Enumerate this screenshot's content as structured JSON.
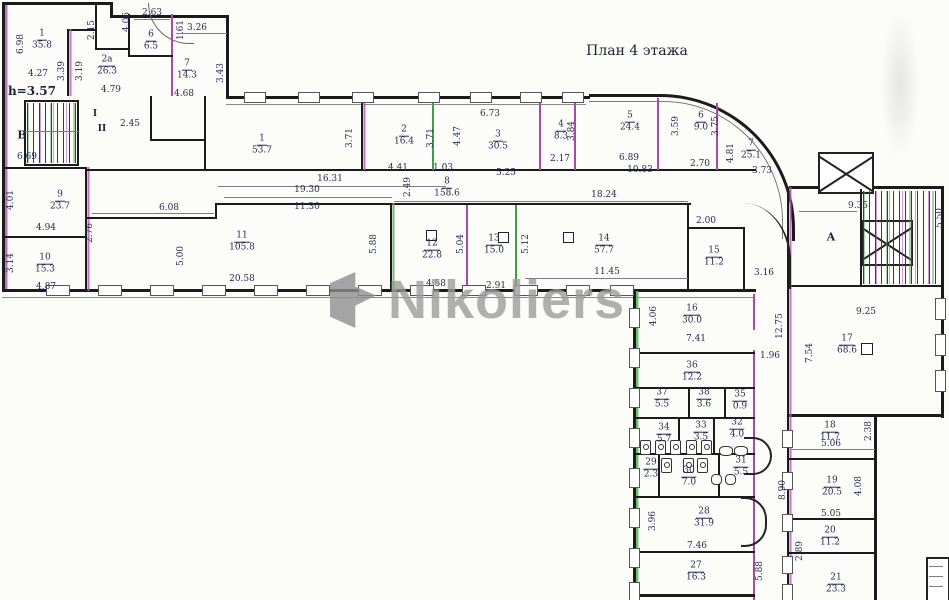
{
  "plan": {
    "title": "План 4 этажа",
    "height_note": "h=3.57",
    "section_markers": [
      "I",
      "II"
    ],
    "stairwell_letters": [
      "В",
      "А"
    ],
    "colors": {
      "wall": "#1b1b1b",
      "accent_magenta": "#a94aa9",
      "accent_green": "#3f9e49",
      "dim_text": "#232c55",
      "watermark_gray": "#9c9c9c",
      "background": "#fcfcf9"
    },
    "rooms": [
      {
        "n": "1",
        "a": "35.8",
        "x": 42,
        "y": 40
      },
      {
        "n": "2а",
        "a": "26.3",
        "x": 107,
        "y": 66
      },
      {
        "n": "6",
        "a": "6.5",
        "x": 151,
        "y": 41
      },
      {
        "n": "7",
        "a": "14.3",
        "x": 187,
        "y": 70
      },
      {
        "n": "1",
        "a": "53.7",
        "x": 262,
        "y": 145
      },
      {
        "n": "2",
        "a": "16.4",
        "x": 404,
        "y": 136
      },
      {
        "n": "3",
        "a": "30.5",
        "x": 498,
        "y": 141
      },
      {
        "n": "4",
        "a": "8.3",
        "x": 561,
        "y": 131
      },
      {
        "n": "5",
        "a": "24.4",
        "x": 630,
        "y": 122
      },
      {
        "n": "6",
        "a": "9.0",
        "x": 701,
        "y": 122
      },
      {
        "n": "7",
        "a": "25.1",
        "x": 751,
        "y": 150
      },
      {
        "n": "8",
        "a": "158.6",
        "x": 447,
        "y": 188
      },
      {
        "n": "9",
        "a": "23.7",
        "x": 60,
        "y": 201
      },
      {
        "n": "10",
        "a": "15.3",
        "x": 45,
        "y": 264
      },
      {
        "n": "11",
        "a": "105.8",
        "x": 242,
        "y": 242
      },
      {
        "n": "12",
        "a": "22.8",
        "x": 432,
        "y": 250
      },
      {
        "n": "13",
        "a": "15.0",
        "x": 494,
        "y": 245
      },
      {
        "n": "14",
        "a": "57.7",
        "x": 604,
        "y": 245
      },
      {
        "n": "15",
        "a": "11.2",
        "x": 714,
        "y": 257
      },
      {
        "n": "16",
        "a": "30.0",
        "x": 692,
        "y": 315
      },
      {
        "n": "17",
        "a": "68.6",
        "x": 847,
        "y": 345
      },
      {
        "n": "18",
        "a": "11.7",
        "x": 830,
        "y": 432
      },
      {
        "n": "19",
        "a": "20.5",
        "x": 832,
        "y": 487
      },
      {
        "n": "20",
        "a": "11.2",
        "x": 830,
        "y": 537
      },
      {
        "n": "21",
        "a": "23.3",
        "x": 836,
        "y": 584
      },
      {
        "n": "27",
        "a": "16.3",
        "x": 696,
        "y": 572
      },
      {
        "n": "28",
        "a": "31.9",
        "x": 704,
        "y": 518
      },
      {
        "n": "29",
        "a": "2.3",
        "x": 651,
        "y": 469
      },
      {
        "n": "30",
        "a": "7.0",
        "x": 689,
        "y": 477
      },
      {
        "n": "31",
        "a": "5.5",
        "x": 741,
        "y": 467
      },
      {
        "n": "32",
        "a": "4.0",
        "x": 737,
        "y": 429
      },
      {
        "n": "33",
        "a": "3.5",
        "x": 701,
        "y": 432
      },
      {
        "n": "34",
        "a": "5.7",
        "x": 664,
        "y": 434
      },
      {
        "n": "35",
        "a": "0.9",
        "x": 740,
        "y": 401
      },
      {
        "n": "36",
        "a": "12.2",
        "x": 692,
        "y": 372
      },
      {
        "n": "37",
        "a": "5.5",
        "x": 662,
        "y": 399
      },
      {
        "n": "38",
        "a": "3.6",
        "x": 704,
        "y": 399
      }
    ],
    "dimensions": [
      {
        "t": "6.98",
        "x": 21,
        "y": 44,
        "v": true
      },
      {
        "t": "4.27",
        "x": 38,
        "y": 74
      },
      {
        "t": "2.15",
        "x": 92,
        "y": 30,
        "v": true
      },
      {
        "t": "3.39",
        "x": 62,
        "y": 71,
        "v": true
      },
      {
        "t": "3.19",
        "x": 80,
        "y": 71,
        "v": true
      },
      {
        "t": "4.79",
        "x": 111,
        "y": 90
      },
      {
        "t": "2.63",
        "x": 152,
        "y": 13
      },
      {
        "t": "4.06",
        "x": 127,
        "y": 22,
        "v": true
      },
      {
        "t": "1.61",
        "x": 181,
        "y": 30,
        "v": true
      },
      {
        "t": "3.26",
        "x": 197,
        "y": 28
      },
      {
        "t": "3.43",
        "x": 221,
        "y": 73,
        "v": true
      },
      {
        "t": "4.68",
        "x": 184,
        "y": 94
      },
      {
        "t": "2.45",
        "x": 130,
        "y": 124
      },
      {
        "t": "6.69",
        "x": 27,
        "y": 157
      },
      {
        "t": "4.01",
        "x": 11,
        "y": 200,
        "v": true
      },
      {
        "t": "4.94",
        "x": 46,
        "y": 228
      },
      {
        "t": "2.76",
        "x": 90,
        "y": 233,
        "v": true
      },
      {
        "t": "3.14",
        "x": 11,
        "y": 263,
        "v": true
      },
      {
        "t": "4.87",
        "x": 46,
        "y": 287
      },
      {
        "t": "6.08",
        "x": 169,
        "y": 208
      },
      {
        "t": "5.00",
        "x": 181,
        "y": 256,
        "v": true
      },
      {
        "t": "20.58",
        "x": 242,
        "y": 279
      },
      {
        "t": "5.88",
        "x": 374,
        "y": 244,
        "v": true
      },
      {
        "t": "16.31",
        "x": 330,
        "y": 179
      },
      {
        "t": "19.30",
        "x": 307,
        "y": 190
      },
      {
        "t": "11.30",
        "x": 307,
        "y": 207
      },
      {
        "t": "3.71",
        "x": 350,
        "y": 138,
        "v": true
      },
      {
        "t": "2.49",
        "x": 408,
        "y": 187,
        "v": true
      },
      {
        "t": "4.41",
        "x": 398,
        "y": 168
      },
      {
        "t": "3.71",
        "x": 431,
        "y": 138,
        "v": true
      },
      {
        "t": "4.47",
        "x": 458,
        "y": 136,
        "v": true
      },
      {
        "t": "6.73",
        "x": 490,
        "y": 114
      },
      {
        "t": "1.03",
        "x": 443,
        "y": 168
      },
      {
        "t": "5.25",
        "x": 506,
        "y": 173
      },
      {
        "t": "3.84",
        "x": 572,
        "y": 131,
        "v": true
      },
      {
        "t": "2.17",
        "x": 560,
        "y": 159
      },
      {
        "t": "18.24",
        "x": 604,
        "y": 195
      },
      {
        "t": "3.59",
        "x": 676,
        "y": 126,
        "v": true
      },
      {
        "t": "6.89",
        "x": 629,
        "y": 158
      },
      {
        "t": "10.83",
        "x": 640,
        "y": 170
      },
      {
        "t": "3.75",
        "x": 716,
        "y": 126,
        "v": true
      },
      {
        "t": "2.70",
        "x": 700,
        "y": 164
      },
      {
        "t": "4.81",
        "x": 731,
        "y": 153,
        "v": true
      },
      {
        "t": "3.73",
        "x": 762,
        "y": 171
      },
      {
        "t": "4.58",
        "x": 436,
        "y": 284
      },
      {
        "t": "5.04",
        "x": 461,
        "y": 244,
        "v": true
      },
      {
        "t": "2.91",
        "x": 496,
        "y": 286
      },
      {
        "t": "5.12",
        "x": 526,
        "y": 244,
        "v": true
      },
      {
        "t": "11.45",
        "x": 607,
        "y": 272
      },
      {
        "t": "2.00",
        "x": 706,
        "y": 221
      },
      {
        "t": "3.16",
        "x": 764,
        "y": 273
      },
      {
        "t": "9.35",
        "x": 858,
        "y": 206
      },
      {
        "t": "5.50",
        "x": 940,
        "y": 218,
        "v": true
      },
      {
        "t": "9.25",
        "x": 866,
        "y": 312
      },
      {
        "t": "7.54",
        "x": 810,
        "y": 353,
        "v": true
      },
      {
        "t": "12.75",
        "x": 780,
        "y": 326,
        "v": true
      },
      {
        "t": "4.06",
        "x": 654,
        "y": 316,
        "v": true
      },
      {
        "t": "7.41",
        "x": 696,
        "y": 339
      },
      {
        "t": "1.96",
        "x": 770,
        "y": 356
      },
      {
        "t": "2.38",
        "x": 869,
        "y": 431,
        "v": true
      },
      {
        "t": "5.06",
        "x": 831,
        "y": 444
      },
      {
        "t": "4.08",
        "x": 859,
        "y": 486,
        "v": true
      },
      {
        "t": "5.05",
        "x": 831,
        "y": 514
      },
      {
        "t": "8.90",
        "x": 783,
        "y": 490,
        "v": true
      },
      {
        "t": "2.89",
        "x": 800,
        "y": 551,
        "v": true
      },
      {
        "t": "3.96",
        "x": 653,
        "y": 521,
        "v": true
      },
      {
        "t": "7.46",
        "x": 697,
        "y": 546
      },
      {
        "t": "5.88",
        "x": 760,
        "y": 571,
        "v": true
      },
      {
        "t": "h=3.57",
        "x": 32,
        "y": 91,
        "cls": "note"
      },
      {
        "t": "В",
        "x": 22,
        "y": 135,
        "cls": "letter"
      },
      {
        "t": "А",
        "x": 831,
        "y": 237,
        "cls": "letter"
      },
      {
        "t": "I",
        "x": 95,
        "y": 114,
        "cls": "roman"
      },
      {
        "t": "II",
        "x": 102,
        "y": 129,
        "cls": "roman"
      }
    ]
  },
  "watermark": {
    "text": "Nikoliers"
  }
}
